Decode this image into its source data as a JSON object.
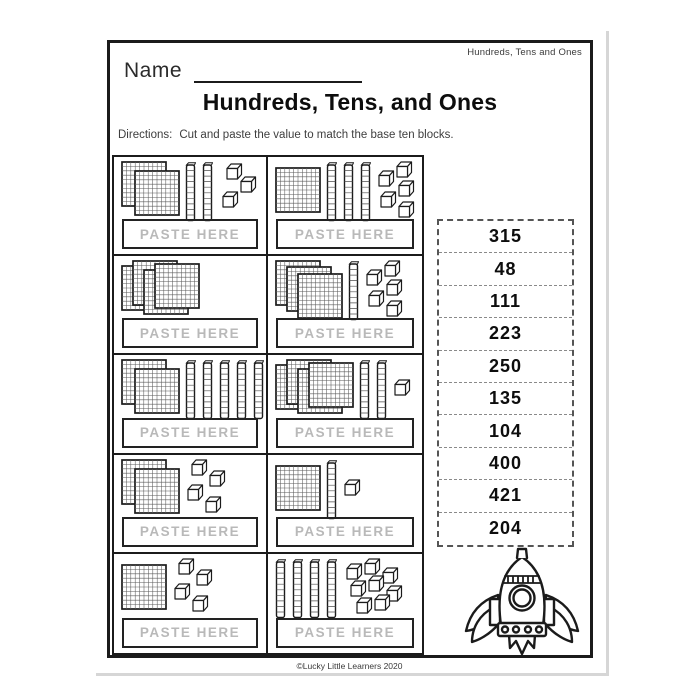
{
  "page": {
    "header_right": "Hundreds, Tens and Ones",
    "name_label": "Name",
    "title": "Hundreds, Tens, and Ones",
    "directions_label": "Directions:",
    "directions_text": "Cut and paste the value to match the base ten blocks.",
    "footer": "©Lucky Little Learners 2020"
  },
  "worksheet": {
    "paste_label": "PASTE HERE",
    "cells": [
      {
        "hundreds": 2,
        "tens": 2,
        "ones": 3
      },
      {
        "hundreds": 1,
        "tens": 3,
        "ones": 5
      },
      {
        "hundreds": 4,
        "tens": 0,
        "ones": 0
      },
      {
        "hundreds": 3,
        "tens": 1,
        "ones": 5
      },
      {
        "hundreds": 2,
        "tens": 5,
        "ones": 0
      },
      {
        "hundreds": 4,
        "tens": 2,
        "ones": 1
      },
      {
        "hundreds": 2,
        "tens": 0,
        "ones": 4
      },
      {
        "hundreds": 1,
        "tens": 1,
        "ones": 1
      },
      {
        "hundreds": 1,
        "tens": 0,
        "ones": 4
      },
      {
        "hundreds": 0,
        "tens": 4,
        "ones": 8
      }
    ],
    "answer_slips": [
      "315",
      "48",
      "111",
      "223",
      "250",
      "135",
      "104",
      "400",
      "421",
      "204"
    ]
  },
  "icons": {
    "hundred_flat": "hundred-flat-icon",
    "ten_rod": "ten-rod-icon",
    "one_cube": "one-cube-icon",
    "rocket": "rocket-icon"
  },
  "colors": {
    "ink": "#1b1b1b",
    "paste_text": "#b9b9b9",
    "muted_text": "#3e3e3e",
    "page_shadow": "#d6d6d6"
  }
}
